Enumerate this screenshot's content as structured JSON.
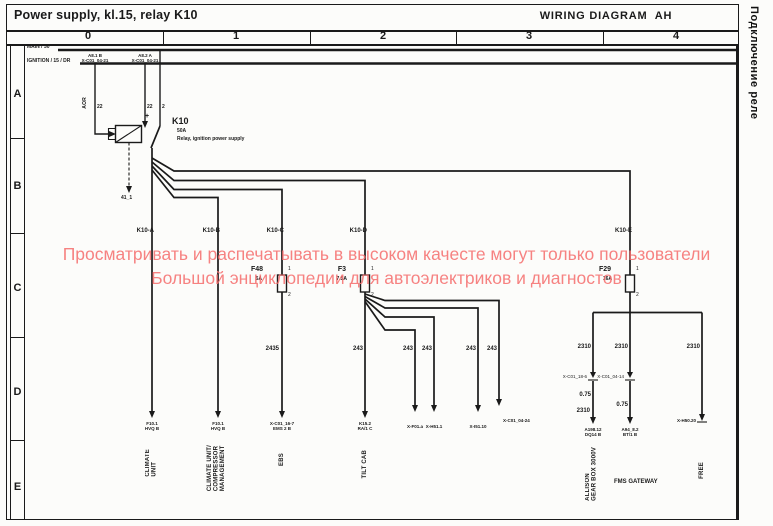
{
  "page": {
    "title": "Power supply, kl.15, relay K10",
    "diagram_title": "WIRING DIAGRAM  AH",
    "side_label": "Подключение реле"
  },
  "grid": {
    "columns": [
      "0",
      "1",
      "2",
      "3",
      "4"
    ],
    "rows": [
      "A",
      "B",
      "C",
      "D",
      "E"
    ]
  },
  "buses": {
    "main": "MAIN / 30",
    "ignition": "IGNITION / 15 / DR"
  },
  "top_connectors": {
    "left": "A8.1 B\nX-C01_04-21",
    "right": "A8.2 A\nX-C01_04-21"
  },
  "relay": {
    "id": "K10",
    "rating": "50A",
    "description": "Relay, ignition power supply",
    "plus": "+",
    "ground": "41_1",
    "coil_wire": "AOR",
    "wire_left": "22",
    "wire_right": "22",
    "wire_main": "2"
  },
  "branches": {
    "a": "K10-A",
    "b": "K10-B",
    "c": "K10-C",
    "d": "K10-D",
    "e": "K10-E"
  },
  "fuses": {
    "f48": {
      "id": "F48",
      "rating": "5A",
      "pin1": "1",
      "pin2": "2"
    },
    "f3": {
      "id": "F3",
      "rating": "7.5A",
      "pin1": "1",
      "pin2": "2"
    },
    "f29": {
      "id": "F29",
      "rating": "16A",
      "pin1": "1",
      "pin2": "2"
    }
  },
  "wire_numbers": {
    "branch_c": "2435",
    "branch_d": "243",
    "branch_e": "2310",
    "e_left_size": "0.75",
    "e_left_lower": "2310",
    "e_mid_size": "0.75"
  },
  "endpoints": {
    "a": "F10.1\nHVQ B",
    "b": "F10.1\nHVQ B",
    "c": "X-C01_16-7\nEMS 2 B",
    "d": "K15.2\nRA/1 C",
    "d1": "X-F01.a",
    "d2": "X-H51.1",
    "d3": "X-I51.10",
    "d4": "X-C01_04-24",
    "e1": "A198.12\nDQ14 B",
    "e2": "A94_8.2\nBT/1 B",
    "e3": "X-H50.20",
    "j1": "X-C01_18-6",
    "j2": "X-C01_04-14"
  },
  "consumers": {
    "climate": "CLIMATE\nUNIT",
    "compressor": "CLIMATE UNIT/\nCOMPRESSOR\nMANAGEMENT",
    "ebs": "EBS",
    "tilt": "TILT CAB",
    "allison": "ALLISON\nGEAR BOX 3000V",
    "fms": "FMS GATEWAY",
    "free": "FREE"
  },
  "watermark": {
    "line1": "Просматривать и распечатывать в высоком качесте могут только пользователи",
    "line2": "Большой энциклопедии для автоэлектриков и диагностов",
    "color": "#f66d6d"
  }
}
